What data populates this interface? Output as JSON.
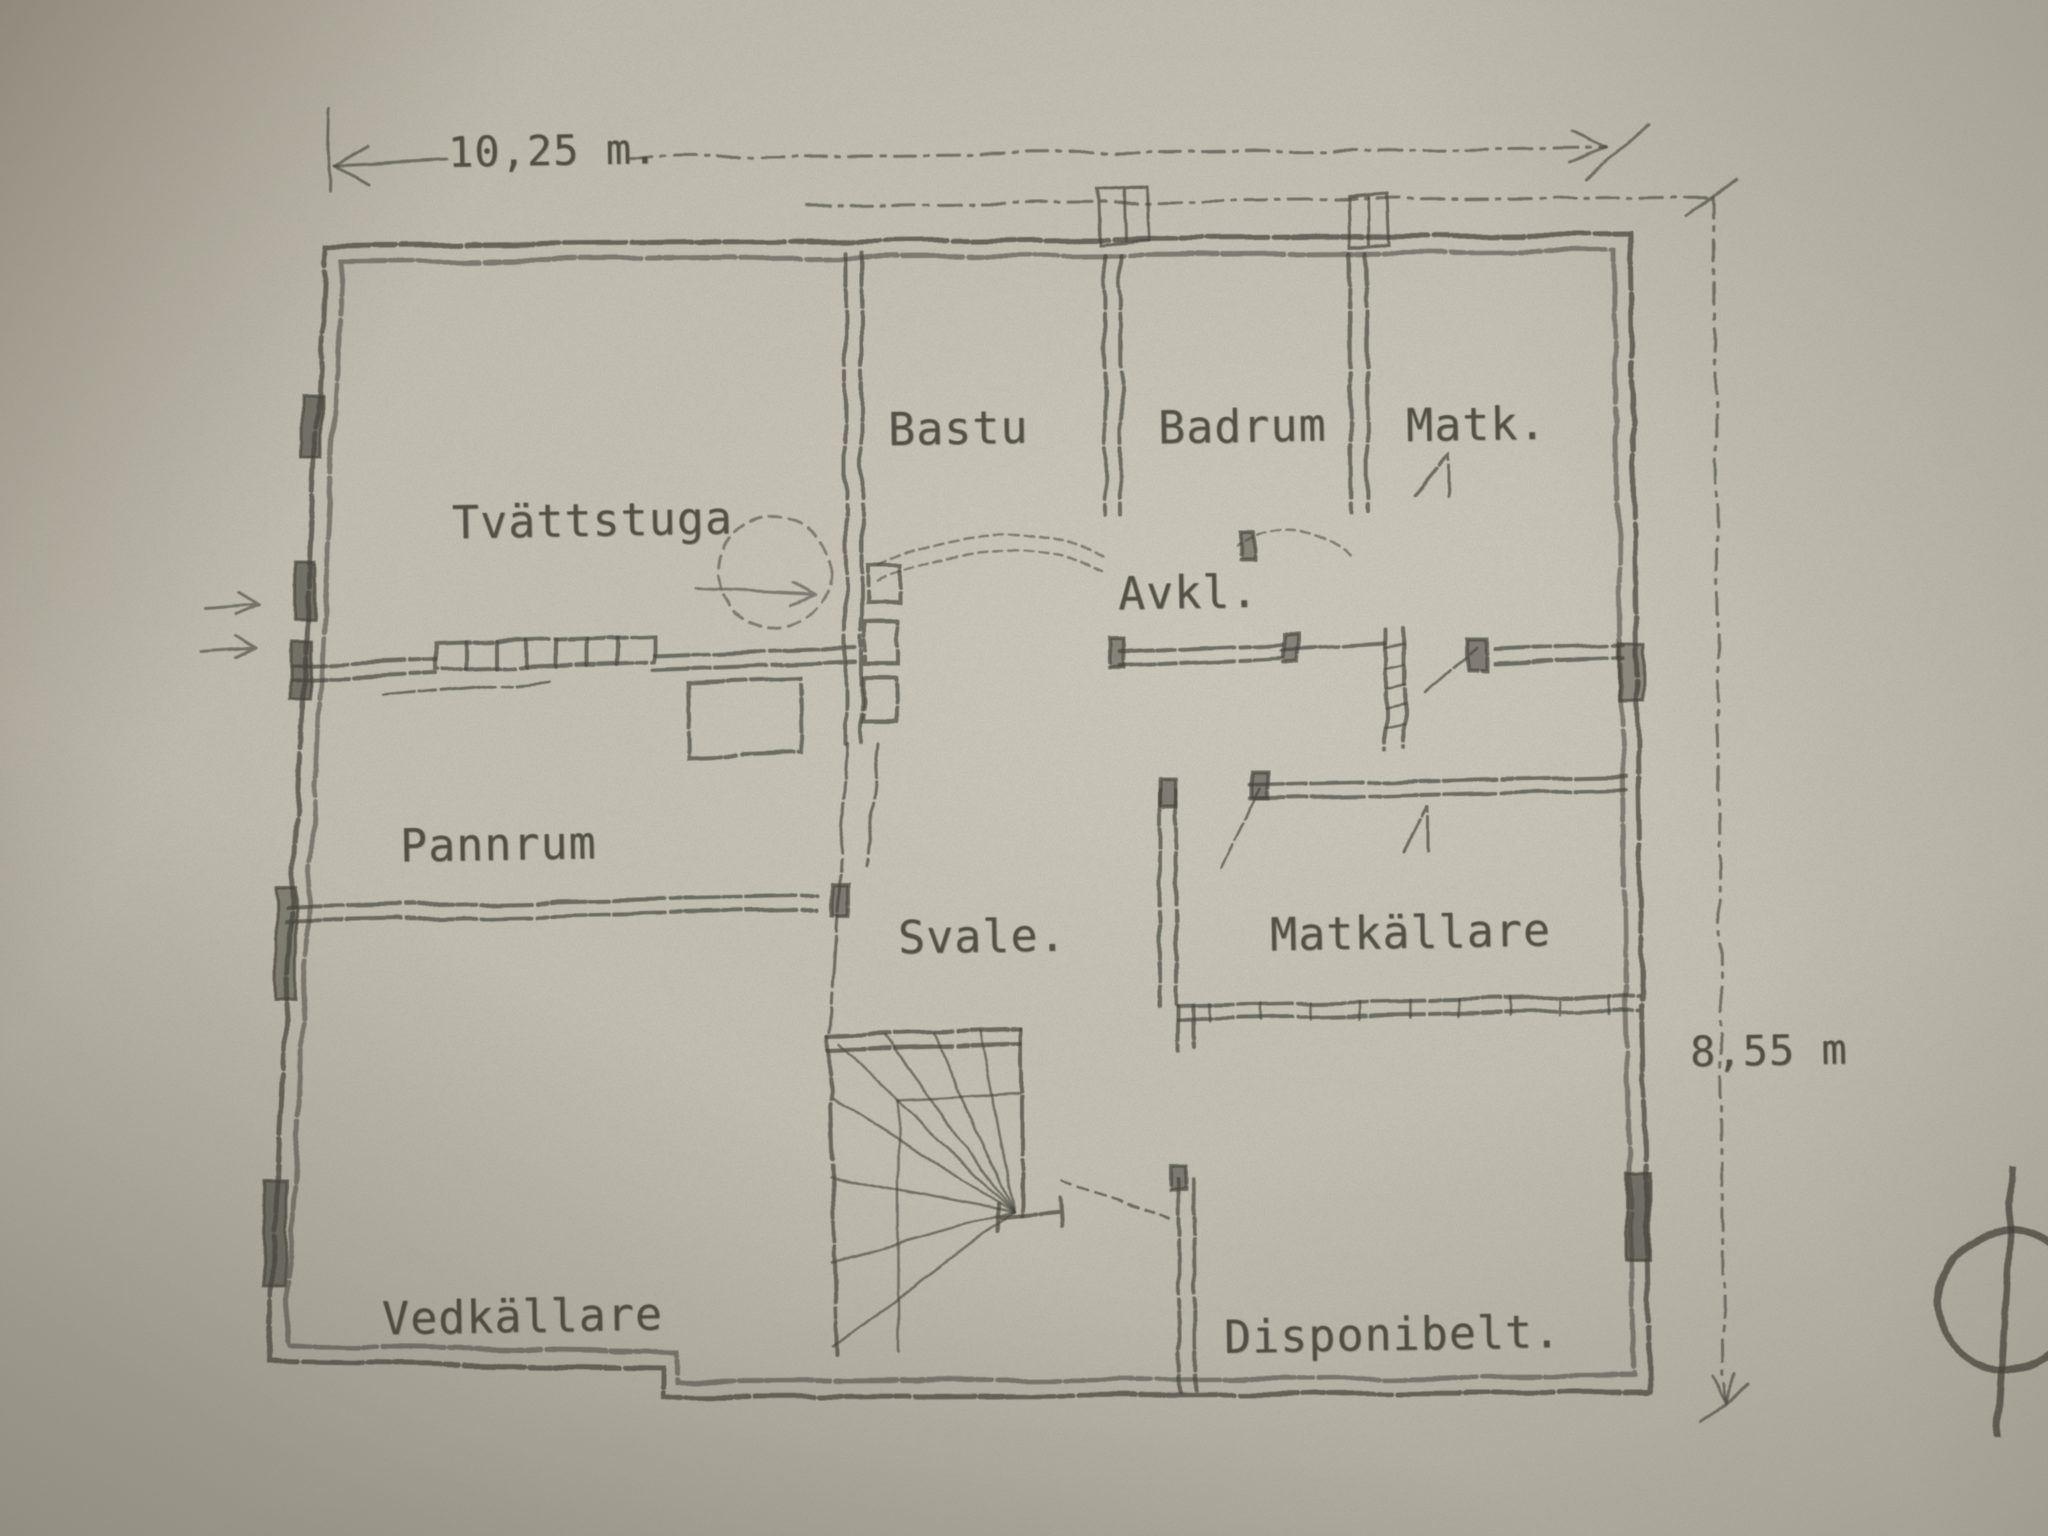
{
  "plan": {
    "rooms": [
      {
        "id": "tvattstuga",
        "label": "Tvättstuga"
      },
      {
        "id": "bastu",
        "label": "Bastu"
      },
      {
        "id": "badrum",
        "label": "Badrum"
      },
      {
        "id": "matk",
        "label": "Matk."
      },
      {
        "id": "avkl",
        "label": "Avkl."
      },
      {
        "id": "pannrum",
        "label": "Pannrum"
      },
      {
        "id": "svale",
        "label": "Svale."
      },
      {
        "id": "matkallare",
        "label": "Matkällare"
      },
      {
        "id": "vedkallare",
        "label": "Vedkällare"
      },
      {
        "id": "disponibelt",
        "label": "Disponibelt."
      }
    ],
    "dimensions": {
      "width": "10,25 m.",
      "height": "8,55 m"
    },
    "colors": {
      "paper": "#bdb9ab",
      "ink": "#3e3b33"
    }
  }
}
